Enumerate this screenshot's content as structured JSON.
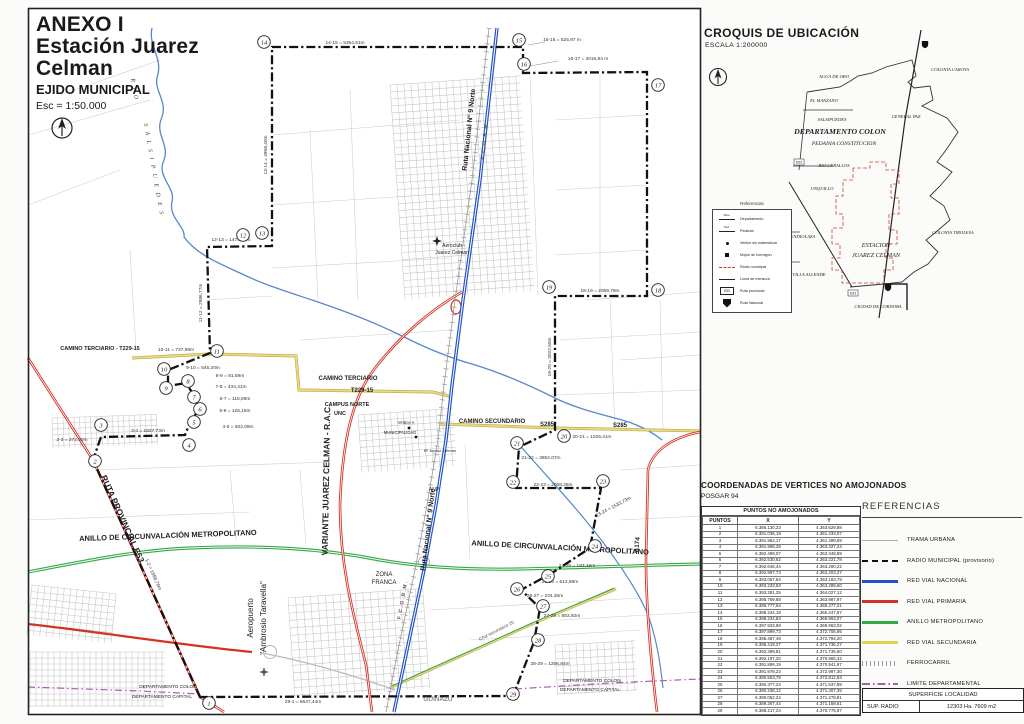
{
  "title_block": {
    "line1": "ANEXO I",
    "line2": "Estación Juarez Celman",
    "line3": "EJIDO MUNICIPAL",
    "line4": "Esc = 1:50.000"
  },
  "croquis": {
    "title": "CROQUIS DE UBICACIÓN",
    "scale": "ESCALA  1:200000",
    "legend": {
      "title": "Referencias",
      "items": [
        {
          "label": "Departamento",
          "sym": "dept",
          "mark": "Dpto."
        },
        {
          "label": "Pedania",
          "sym": "dept",
          "mark": "Ped."
        },
        {
          "label": "Vertice sin materializar",
          "sym": "dot"
        },
        {
          "label": "Mojón de hormigón",
          "sym": "square"
        },
        {
          "label": "Radio municipal",
          "sym": "reddash"
        },
        {
          "label": "Línea de mensura",
          "sym": "line"
        },
        {
          "label": "Ruta provincial",
          "sym": "e53",
          "badge": "E53"
        },
        {
          "label": "Ruta Nacional",
          "sym": "shield"
        }
      ]
    },
    "labels": [
      {
        "t": "AGUA DE ORO",
        "x": 834,
        "y": 78,
        "s": 4.6
      },
      {
        "t": "EL MANZANO",
        "x": 824,
        "y": 102,
        "s": 4.6
      },
      {
        "t": "SALSIPUEDES",
        "x": 832,
        "y": 121,
        "s": 4.6
      },
      {
        "t": "DEPARTAMENTO COLON",
        "x": 840,
        "y": 134,
        "s": 7.8,
        "w": 700
      },
      {
        "t": "PEDANIA CONSTITUCION",
        "x": 844,
        "y": 145,
        "s": 5.6
      },
      {
        "t": "GENERAL PAZ",
        "x": 906,
        "y": 118,
        "s": 4.6
      },
      {
        "t": "COLONIA CAROYA",
        "x": 950,
        "y": 71,
        "s": 4.6
      },
      {
        "t": "RIO CEBALLOS",
        "x": 834,
        "y": 167,
        "s": 4.6
      },
      {
        "t": "UNQUILLO",
        "x": 822,
        "y": 190,
        "s": 4.6
      },
      {
        "t": "MENDIOLAZA",
        "x": 801,
        "y": 238,
        "s": 4.6
      },
      {
        "t": "ESTACION",
        "x": 876,
        "y": 247,
        "s": 6.2
      },
      {
        "t": "JUAREZ CELMAN",
        "x": 876,
        "y": 257,
        "s": 6.2
      },
      {
        "t": "COLONIA TIROLESA",
        "x": 953,
        "y": 234,
        "s": 4.6
      },
      {
        "t": "VILLA ALLENDE",
        "x": 809,
        "y": 276,
        "s": 4.6
      },
      {
        "t": "CIUDAD DE CORDOBA",
        "x": 878,
        "y": 308,
        "s": 4.6
      }
    ]
  },
  "coords_table": {
    "heading": "COORDENADAS DE VERTICES NO AMOJONADOS",
    "datum": "POSGAR 94",
    "table_title": "PUNTOS NO AMOJONADOS",
    "columns": [
      "PUNTOS",
      "X",
      "Y"
    ],
    "rows": [
      [
        "1",
        "6.386.130,23",
        "4.363.629,88"
      ],
      [
        "2",
        "6.391.036,19",
        "4.361.433,07"
      ],
      [
        "3",
        "6.391.962,17",
        "4.361.499,59"
      ],
      [
        "4",
        "6.391.999,28",
        "4.363.327,24"
      ],
      [
        "5",
        "6.392.499,07",
        "4.363.348,89"
      ],
      [
        "6",
        "6.392.530,62",
        "4.363.221,78"
      ],
      [
        "7",
        "6.392.648,44",
        "4.363.290,22"
      ],
      [
        "8",
        "6.392.997,74",
        "4.363.203,27"
      ],
      [
        "9",
        "6.393.067,84",
        "4.363.183,79"
      ],
      [
        "10",
        "6.393.233,63",
        "4.363.289,60"
      ],
      [
        "11",
        "6.393.281,25",
        "4.364.027,12"
      ],
      [
        "12",
        "6.395.769,88",
        "4.363.987,97"
      ],
      [
        "13",
        "6.395.777,64",
        "4.365.277,21"
      ],
      [
        "14",
        "6.398.234,18",
        "4.365.247,87"
      ],
      [
        "15",
        "6.398.234,83",
        "4.369.963,07"
      ],
      [
        "16",
        "6.397.933,98",
        "4.369.963,02"
      ],
      [
        "17",
        "6.397.899,73",
        "4.372.706,95"
      ],
      [
        "18",
        "6.395.487,48",
        "4.372.794,20"
      ],
      [
        "19",
        "6.395.419,27",
        "4.371.736,27"
      ],
      [
        "20",
        "6.392.399,81",
        "4.371.735,60"
      ],
      [
        "21",
        "6.392.197,20",
        "4.370.965,32"
      ],
      [
        "22",
        "6.391.899,19",
        "4.370.941,97"
      ],
      [
        "23",
        "6.391.978,23",
        "4.372.997,30"
      ],
      [
        "24",
        "6.390.553,78",
        "4.372.812,93"
      ],
      [
        "25",
        "6.390.377,24",
        "4.371.537,89"
      ],
      [
        "26",
        "6.390.238,12",
        "4.371.407,35"
      ],
      [
        "27",
        "6.390.052,24",
        "4.371.279,81"
      ],
      [
        "28",
        "6.389.267,44",
        "4.371.158,61"
      ],
      [
        "29",
        "6.388.217,24",
        "4.370.775,87"
      ]
    ]
  },
  "references": {
    "title": "REFERENCIAS",
    "items": [
      {
        "label": "TRAMA URBANA",
        "style": "solid-thin",
        "color": "#aaaaaa"
      },
      {
        "label": "RADIO MUNICIPAL (provisorio)",
        "style": "dashed-thick",
        "color": "#111111"
      },
      {
        "label": "RED VIAL NACIONAL",
        "style": "solid",
        "color": "#2353c4"
      },
      {
        "label": "RED VIAL PRIMARIA",
        "style": "solid",
        "color": "#d43225"
      },
      {
        "label": "ANILLO METROPOLITANO",
        "style": "solid",
        "color": "#33a844"
      },
      {
        "label": "RED VIAL SECUNDARIA",
        "style": "solid",
        "color": "#e5d054"
      },
      {
        "label": "FERROCARRIL",
        "style": "hatch",
        "color": "#999999"
      },
      {
        "label": "LIMITE DEPARTAMENTAL",
        "style": "dashdot",
        "color": "#b05ab0"
      }
    ]
  },
  "superficie": {
    "title": "SUPERFICIE LOCALIDAD",
    "label": "SUP.  RADIO",
    "value": "12303 Ha. 7609 m2"
  },
  "map": {
    "vertices": [
      {
        "n": "1",
        "x": 209,
        "y": 703
      },
      {
        "n": "2",
        "x": 95,
        "y": 461
      },
      {
        "n": "3",
        "x": 101,
        "y": 425
      },
      {
        "n": "4",
        "x": 189,
        "y": 445
      },
      {
        "n": "5",
        "x": 194,
        "y": 422
      },
      {
        "n": "6",
        "x": 200,
        "y": 409
      },
      {
        "n": "7",
        "x": 194,
        "y": 397
      },
      {
        "n": "8",
        "x": 188,
        "y": 381
      },
      {
        "n": "9",
        "x": 166,
        "y": 388
      },
      {
        "n": "10",
        "x": 164,
        "y": 369
      },
      {
        "n": "11",
        "x": 217,
        "y": 351
      },
      {
        "n": "12",
        "x": 243,
        "y": 235
      },
      {
        "n": "13",
        "x": 262,
        "y": 233
      },
      {
        "n": "14",
        "x": 264,
        "y": 42
      },
      {
        "n": "15",
        "x": 519,
        "y": 40
      },
      {
        "n": "16",
        "x": 524,
        "y": 64
      },
      {
        "n": "17",
        "x": 658,
        "y": 85
      },
      {
        "n": "18",
        "x": 658,
        "y": 290
      },
      {
        "n": "19",
        "x": 549,
        "y": 287
      },
      {
        "n": "20",
        "x": 564,
        "y": 436
      },
      {
        "n": "21",
        "x": 517,
        "y": 443
      },
      {
        "n": "22",
        "x": 513,
        "y": 482
      },
      {
        "n": "23",
        "x": 603,
        "y": 481
      },
      {
        "n": "24",
        "x": 595,
        "y": 546
      },
      {
        "n": "25",
        "x": 548,
        "y": 576
      },
      {
        "n": "26",
        "x": 517,
        "y": 589
      },
      {
        "n": "27",
        "x": 543,
        "y": 606
      },
      {
        "n": "28",
        "x": 538,
        "y": 640
      },
      {
        "n": "29",
        "x": 513,
        "y": 694
      }
    ],
    "segment_labels": [
      {
        "t": "14-15 = 5354,61m",
        "x": 345,
        "y": 44
      },
      {
        "t": "15-16 = 525,97 m",
        "x": 562,
        "y": 41
      },
      {
        "t": "16-17 = 3016,84 m",
        "x": 588,
        "y": 60
      },
      {
        "t": "13-14 = 4958,40m",
        "x": 267,
        "y": 155,
        "r": -90
      },
      {
        "t": "12-13 = 1475,39m",
        "x": 231,
        "y": 241
      },
      {
        "t": "11-12 = 2586,77m",
        "x": 202,
        "y": 303,
        "r": -90
      },
      {
        "t": "10-11 = 737,99m",
        "x": 176,
        "y": 351
      },
      {
        "t": "9-10 = 545,20m",
        "x": 203,
        "y": 369
      },
      {
        "t": "8-9 = 81,59m",
        "x": 230,
        "y": 377
      },
      {
        "t": "7-8 = 434,31m",
        "x": 231,
        "y": 388
      },
      {
        "t": "6-7 = 115,89m",
        "x": 235,
        "y": 400
      },
      {
        "t": "5-6 = 126,15m",
        "x": 235,
        "y": 412
      },
      {
        "t": "4-5 = 502,09m",
        "x": 238,
        "y": 428
      },
      {
        "t": "3-4 = 1827,73m",
        "x": 148,
        "y": 432
      },
      {
        "t": "2-3 = 372,50m",
        "x": 72,
        "y": 441
      },
      {
        "t": "1-2 = 1898,76m",
        "x": 152,
        "y": 575,
        "r": 66
      },
      {
        "t": "29-1 = 6647,44m",
        "x": 303,
        "y": 703
      },
      {
        "t": "18-19 = 2059,79m",
        "x": 600,
        "y": 292
      },
      {
        "t": "19-20 = 3022,50m",
        "x": 551,
        "y": 357,
        "r": -90
      },
      {
        "t": "20-21 = 1026,41m",
        "x": 592,
        "y": 438
      },
      {
        "t": "21-22 = 3852,07m",
        "x": 541,
        "y": 459
      },
      {
        "t": "22-23 = 2068,25m",
        "x": 553,
        "y": 486
      },
      {
        "t": "23-24 = 1533,73m",
        "x": 614,
        "y": 508,
        "r": -28
      },
      {
        "t": "24-25 = 183,15m",
        "x": 577,
        "y": 567
      },
      {
        "t": "25-26 = 612,68m",
        "x": 560,
        "y": 583
      },
      {
        "t": "26-27 = 234,30m",
        "x": 545,
        "y": 597
      },
      {
        "t": "27-28 = 853,92m",
        "x": 562,
        "y": 617
      },
      {
        "t": "28-29 = 1256,84m",
        "x": 550,
        "y": 665
      }
    ],
    "labels": [
      {
        "t": "R I O",
        "x": 133,
        "y": 90,
        "r": 80,
        "s": 6,
        "f": "serif",
        "i": 1,
        "ls": 2,
        "c": "#444"
      },
      {
        "t": "S A L S I P U E D E S",
        "x": 152,
        "y": 170,
        "r": 80,
        "s": 6,
        "f": "serif",
        "i": 1,
        "ls": 2,
        "c": "#444"
      },
      {
        "t": "CAMINO TERCIARIO - T229-15",
        "x": 100,
        "y": 350,
        "s": 5.5,
        "w": 600
      },
      {
        "t": "CAMINO TERCIARIO",
        "x": 348,
        "y": 380,
        "s": 6,
        "w": 600
      },
      {
        "t": "T229-15",
        "x": 362,
        "y": 392,
        "s": 6,
        "w": 600
      },
      {
        "t": "CAMPUS NORTE",
        "x": 347,
        "y": 406,
        "s": 5.5,
        "w": 600
      },
      {
        "t": "UNC",
        "x": 340,
        "y": 415,
        "s": 5.5,
        "w": 600
      },
      {
        "t": "CAMINO SECUNDARIO",
        "x": 492,
        "y": 423,
        "s": 6,
        "w": 600
      },
      {
        "t": "S285",
        "x": 547,
        "y": 426,
        "s": 6,
        "w": 600
      },
      {
        "t": "S285",
        "x": 620,
        "y": 427,
        "s": 6,
        "w": 600
      },
      {
        "t": "ANILLO DE CIRCUNVALACIÓN METROPOLITANO",
        "x": 168,
        "y": 538,
        "r": -2,
        "s": 7.5,
        "w": 700
      },
      {
        "t": "ANILLO DE CIRCUNVALACIÓN METROPOLITANO",
        "x": 560,
        "y": 550,
        "r": 3,
        "s": 7.5,
        "w": 700
      },
      {
        "t": "RUTA PROVINCIAL E53",
        "x": 120,
        "y": 520,
        "r": 66,
        "s": 8.5,
        "w": 700
      },
      {
        "t": "VARIANTE JUAREZ CELMAN - R.A.C.",
        "x": 329,
        "y": 480,
        "r": -89,
        "s": 8.5,
        "w": 700
      },
      {
        "t": "Ruta Nacional N° 9 Norte",
        "x": 471,
        "y": 130,
        "r": -84,
        "s": 7,
        "w": 700
      },
      {
        "t": "Ruta Nacional N° 9 Norte",
        "x": 430,
        "y": 530,
        "r": -83,
        "s": 7,
        "w": 700
      },
      {
        "t": "F.C.G.B.M.",
        "x": 486,
        "y": 140,
        "r": -84,
        "s": 5,
        "w": 600,
        "ls": 1.5,
        "c": "#555"
      },
      {
        "t": "F.C.G.B.M.",
        "x": 404,
        "y": 600,
        "r": -80,
        "s": 5,
        "w": 600,
        "ls": 1.5,
        "c": "#555"
      },
      {
        "t": "A174",
        "x": 639,
        "y": 545,
        "r": -85,
        "s": 6.5,
        "w": 700
      },
      {
        "t": "Aeroclub",
        "x": 452,
        "y": 247,
        "s": 5
      },
      {
        "t": "Juarez Celman",
        "x": 452,
        "y": 254,
        "s": 5
      },
      {
        "t": "Aeropuerto",
        "x": 253,
        "y": 618,
        "r": -90,
        "s": 8
      },
      {
        "t": "\"Ambrosio Taravella\"",
        "x": 266,
        "y": 618,
        "r": -90,
        "s": 8
      },
      {
        "t": "ZONA",
        "x": 384,
        "y": 576,
        "s": 6
      },
      {
        "t": "FRANCA",
        "x": 384,
        "y": 584,
        "s": 6
      },
      {
        "t": "GUIÑAZU",
        "x": 438,
        "y": 701,
        "s": 6.5,
        "c": "#555"
      },
      {
        "t": "DEPARTAMENTO COLON",
        "x": 168,
        "y": 688,
        "s": 4.8
      },
      {
        "t": "DEPARTAMENTO CAPITAL",
        "x": 162,
        "y": 698,
        "s": 4.8
      },
      {
        "t": "DEPARTAMENTO COLON",
        "x": 592,
        "y": 682,
        "s": 4.8
      },
      {
        "t": "DEPARTAMENTO CAPITAL",
        "x": 590,
        "y": 691,
        "s": 4.8
      },
      {
        "t": "MUNICIPALIDAD",
        "x": 400,
        "y": 434,
        "s": 4.2
      },
      {
        "t": "Vértice A",
        "x": 406,
        "y": 424,
        "s": 4.2
      },
      {
        "t": "Bº Juarez Celman",
        "x": 440,
        "y": 452,
        "s": 4
      },
      {
        "t": "ANP",
        "x": 434,
        "y": 491,
        "s": 5
      },
      {
        "t": "Cñal secundario 25",
        "x": 497,
        "y": 632,
        "r": -27,
        "s": 4.5,
        "c": "#555"
      }
    ]
  }
}
